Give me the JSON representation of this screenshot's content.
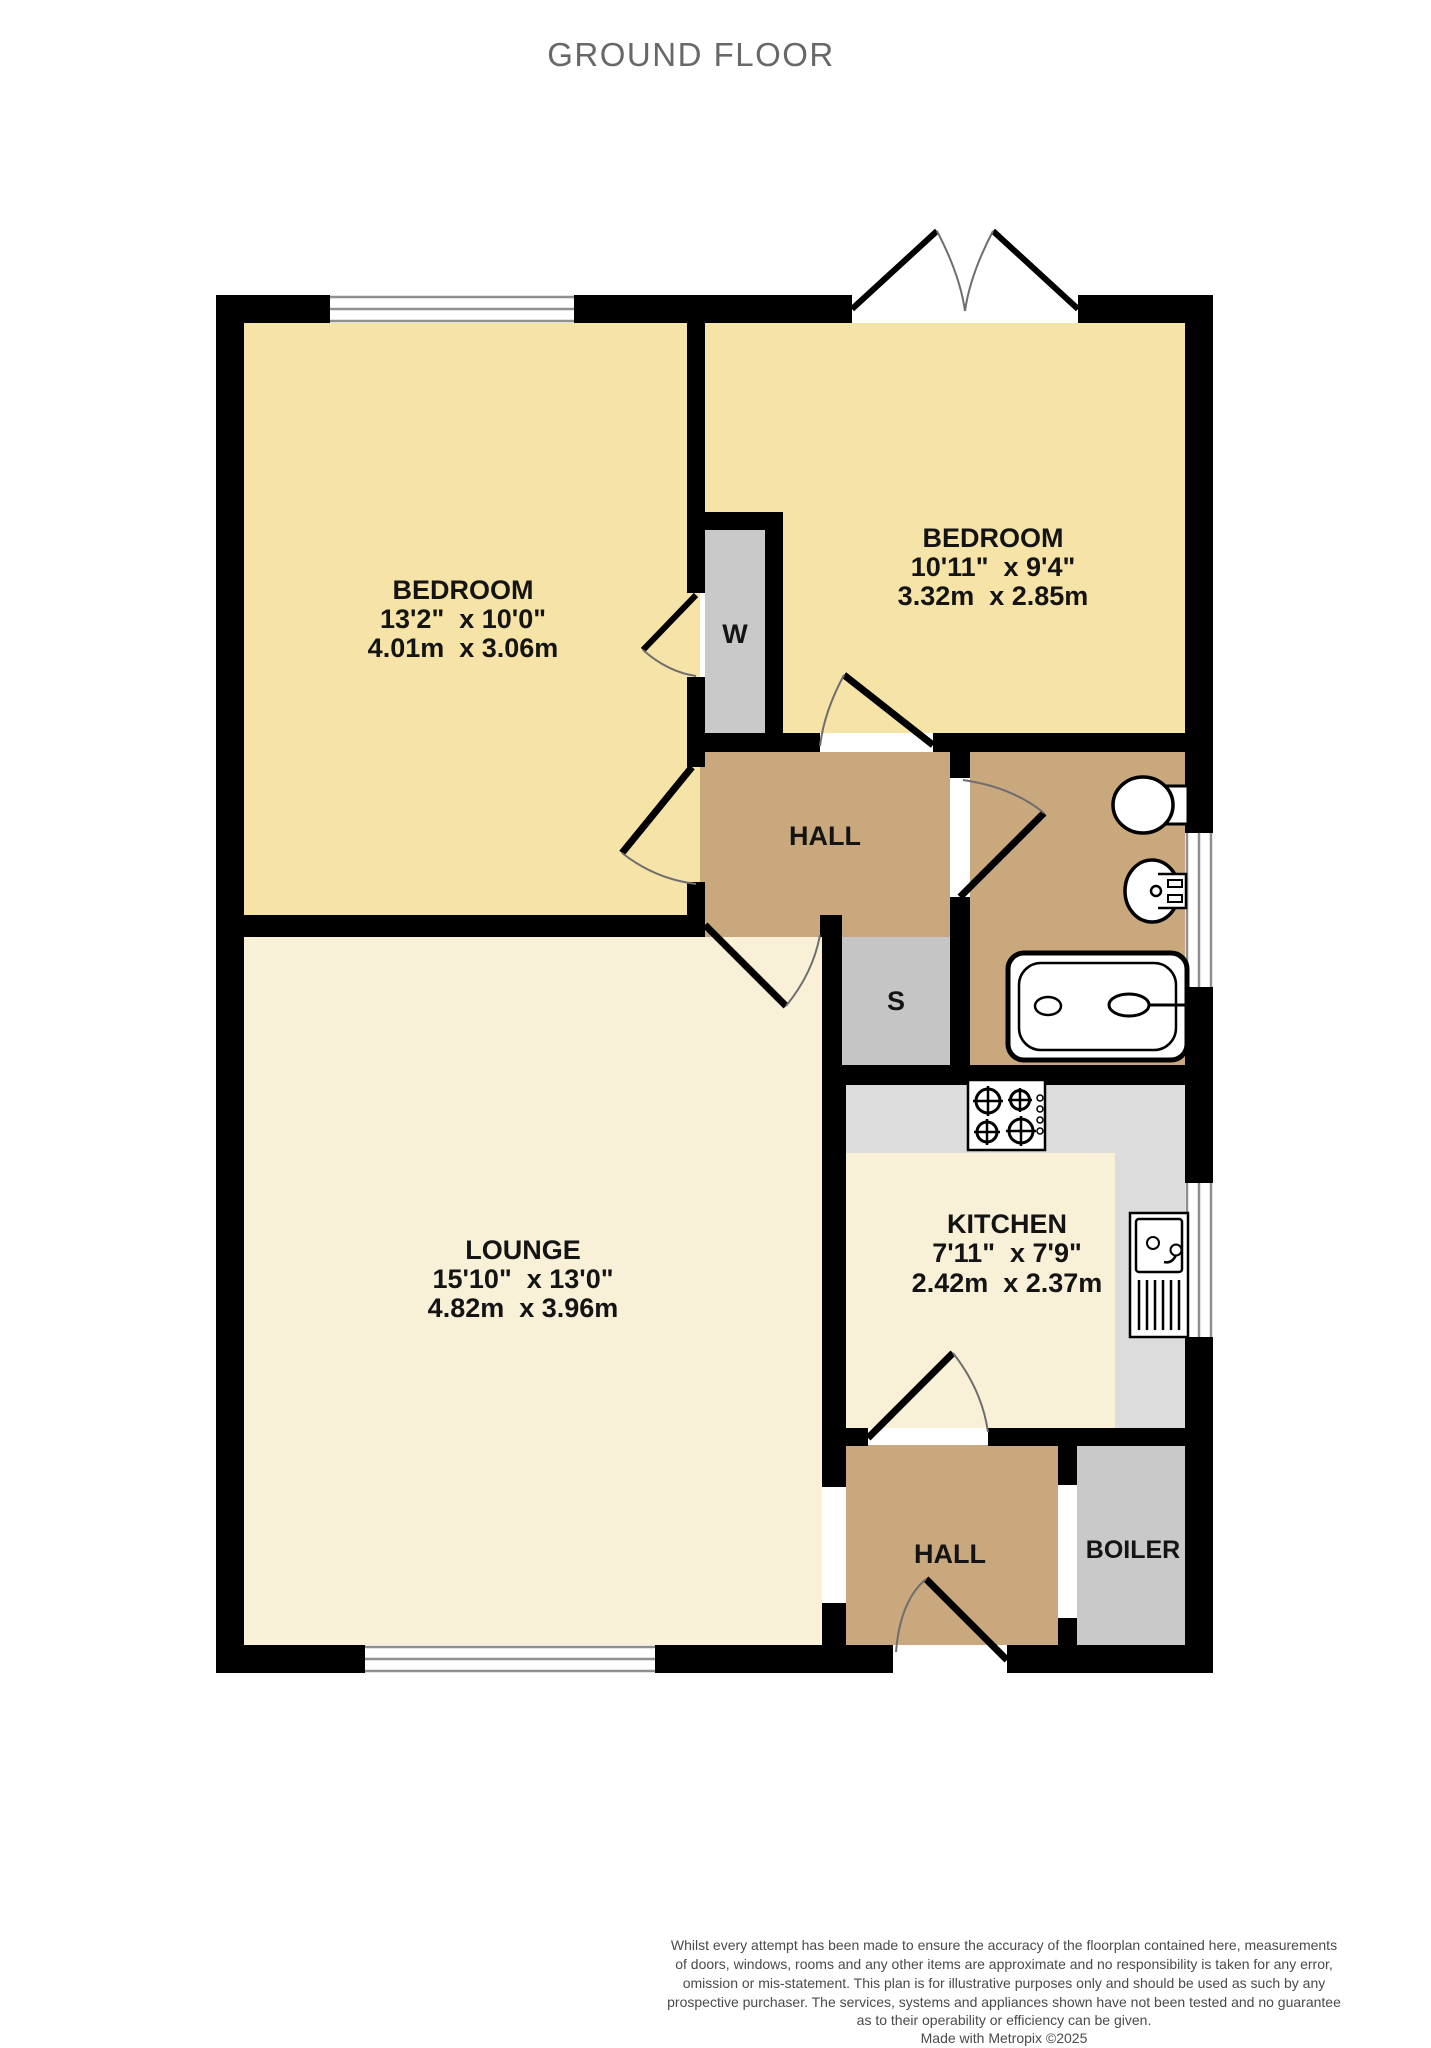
{
  "title": "GROUND FLOOR",
  "floor_name": "Ground Floor",
  "rooms": {
    "bedroom1": {
      "name": "BEDROOM",
      "imperial": "13'2\"  x 10'0\"",
      "metric": "4.01m  x 3.06m"
    },
    "bedroom2": {
      "name": "BEDROOM",
      "imperial": "10'11\"  x 9'4\"",
      "metric": "3.32m  x 2.85m"
    },
    "lounge": {
      "name": "LOUNGE",
      "imperial": "15'10\"  x 13'0\"",
      "metric": "4.82m  x 3.96m"
    },
    "kitchen": {
      "name": "KITCHEN",
      "imperial": "7'11\"  x 7'9\"",
      "metric": "2.42m  x 2.37m"
    },
    "hall_upper": {
      "name": "HALL"
    },
    "hall_lower": {
      "name": "HALL"
    },
    "boiler": {
      "name": "BOILER"
    },
    "wardrobe": {
      "name": "W"
    },
    "store": {
      "name": "S"
    }
  },
  "fixtures": [
    "toilet",
    "basin",
    "bath",
    "hob",
    "kitchen-sink"
  ],
  "colors": {
    "bedroom_floor": "#F6E3A7",
    "lounge_kitchen_floor": "#F8F1D8",
    "hall_bath_floor": "#C9A87E",
    "store_gray": "#C5C5C5",
    "closet_gray": "#C9C9C9",
    "counter_gray": "#DCDCDC",
    "wall": "#000000",
    "title_gray": "#686868"
  },
  "disclaimer": {
    "lines": [
      "Whilst every attempt has been made to ensure the accuracy of the floorplan contained here, measurements",
      "of doors, windows, rooms and any other items are approximate and no responsibility is taken for any error,",
      "omission or mis-statement. This plan is for illustrative purposes only and should be used as such by any",
      "prospective purchaser. The services, systems and appliances shown have not been tested and no guarantee",
      "as to their operability or efficiency can be given."
    ],
    "credit": "Made with Metropix ©2025"
  }
}
